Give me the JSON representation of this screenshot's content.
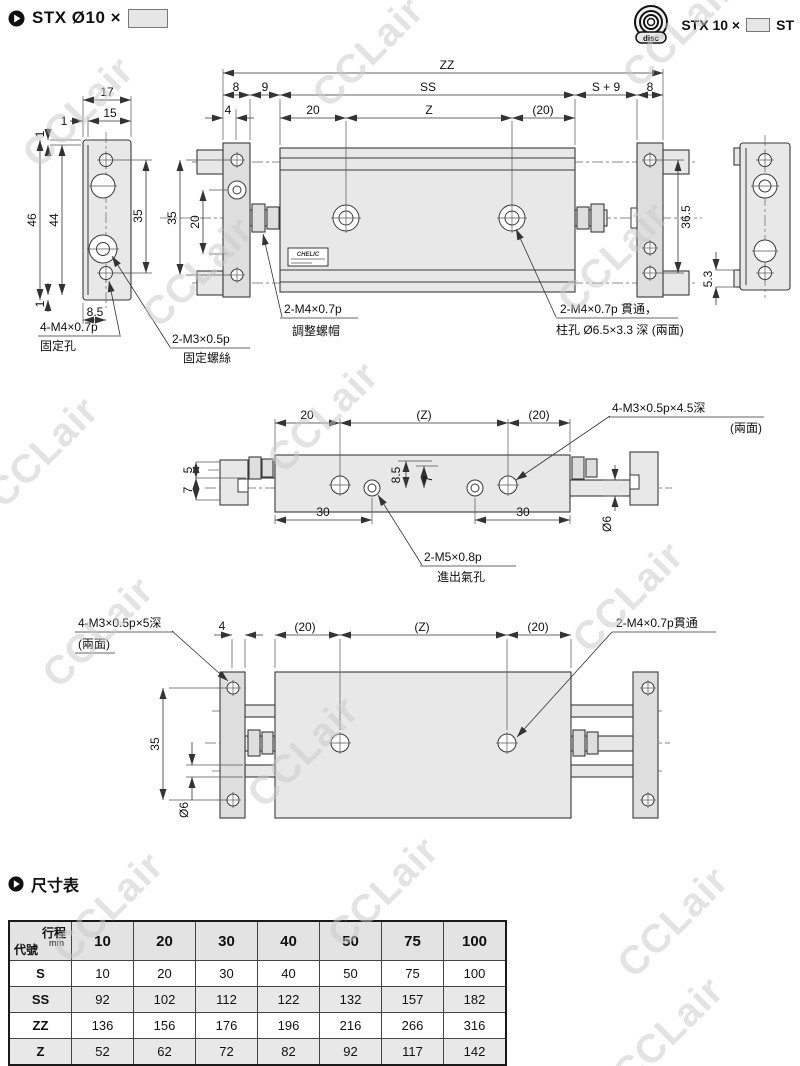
{
  "header": {
    "title": "STX Ø10 ×",
    "right1": "STX 10 ×",
    "right2": "ST",
    "disc": "disc"
  },
  "watermark": {
    "text": "CCLair"
  },
  "drawing1": {
    "zz": "ZZ",
    "ss": "SS",
    "n8l": "8",
    "n9": "9",
    "n4": "4",
    "n20": "20",
    "z": "Z",
    "p20": "(20)",
    "s9": "S + 9",
    "n8r": "8",
    "n17": "17",
    "n15": "15",
    "n1t": "1",
    "n1v": "1",
    "n46": "46",
    "n44": "44",
    "n35s": "35",
    "n85": "8.5",
    "n1b": "1",
    "n35p": "35",
    "n20p": "20",
    "n365": "36.5",
    "n53": "5.3",
    "fix1": "4-M4×0.7p",
    "fix2": "固定孔",
    "scr1": "2-M3×0.5p",
    "scr2": "固定螺絲",
    "adj1": "2-M4×0.7p",
    "adj2": "調整螺帽",
    "thr1": "2-M4×0.7p 貫通，",
    "thr2": "柱孔 Ø6.5×3.3 深 (兩面)",
    "brand": "CHELIC"
  },
  "drawing2": {
    "n20": "20",
    "pz": "(Z)",
    "p20": "(20)",
    "n5": "5",
    "n7l": "7",
    "n85": "8.5",
    "n7m": "7",
    "n30l": "30",
    "n30r": "30",
    "d6": "Ø6",
    "m31": "4-M3×0.5p×4.5深",
    "m32": "(兩面)",
    "m51": "2-M5×0.8p",
    "m52": "進出氣孔"
  },
  "drawing3": {
    "n4": "4",
    "p20l": "(20)",
    "pz": "(Z)",
    "p20r": "(20)",
    "n35": "35",
    "d6": "Ø6",
    "m31": "4-M3×0.5p×5深",
    "m32": "(兩面)",
    "thr": "2-M4×0.7p貫通"
  },
  "table": {
    "title": "尺寸表",
    "corner_top": "行程",
    "corner_unit": "mm",
    "corner_bottom": "代號",
    "cols": [
      "10",
      "20",
      "30",
      "40",
      "50",
      "75",
      "100"
    ],
    "rows": [
      {
        "label": "S",
        "values": [
          "10",
          "20",
          "30",
          "40",
          "50",
          "75",
          "100"
        ]
      },
      {
        "label": "SS",
        "values": [
          "92",
          "102",
          "112",
          "122",
          "132",
          "157",
          "182"
        ]
      },
      {
        "label": "ZZ",
        "values": [
          "136",
          "156",
          "176",
          "196",
          "216",
          "266",
          "316"
        ]
      },
      {
        "label": "Z",
        "values": [
          "52",
          "62",
          "72",
          "82",
          "92",
          "117",
          "142"
        ]
      }
    ]
  }
}
